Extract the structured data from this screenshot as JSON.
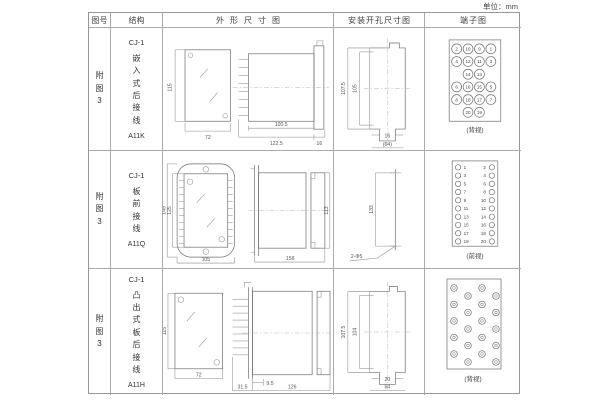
{
  "unit_label": "单位：mm",
  "table": {
    "headers": [
      "图号",
      "结构",
      "外形尺寸图",
      "安装开孔尺寸图",
      "端子图"
    ],
    "rows": [
      {
        "figure_no": "附图3",
        "structure": {
          "model": "CJ-1",
          "desc": "嵌入式后接线",
          "code": "A11K"
        },
        "outline_dims": {
          "h": "115",
          "w": "72",
          "body": "100.5",
          "total": "122.5",
          "flange": "16"
        },
        "mounting_dims": {
          "outer": "107.5",
          "inner": "105",
          "slot": "16",
          "overall": "(64)"
        },
        "terminal": {
          "view": "(背视)",
          "layout": "grid",
          "numbers": [
            [
              2,
              10,
              9,
              1
            ],
            [
              4,
              12,
              11,
              3
            ],
            [
              null,
              14,
              13,
              null
            ],
            [
              6,
              16,
              15,
              5
            ],
            [
              8,
              18,
              17,
              7
            ],
            [
              null,
              20,
              19,
              null
            ]
          ]
        }
      },
      {
        "figure_no": "附图3",
        "structure": {
          "model": "CJ-1",
          "desc": "板前接线",
          "code": "A11Q"
        },
        "outline_dims": {
          "outer_h": "149",
          "inner_h": "125",
          "w": "105",
          "len": "156",
          "side_h": "113"
        },
        "mounting_dims": {
          "spacing": "133",
          "holes": "2-Φ5"
        },
        "terminal": {
          "view": "(前视)",
          "layout": "two-col",
          "left": [
            1,
            3,
            5,
            7,
            9,
            11,
            13,
            15,
            17,
            19
          ],
          "right": [
            2,
            4,
            6,
            8,
            10,
            12,
            14,
            16,
            18,
            20
          ]
        }
      },
      {
        "figure_no": "附图3",
        "structure": {
          "model": "CJ-1",
          "desc": "凸出式板后接线",
          "code": "A11H"
        },
        "outline_dims": {
          "h": "115",
          "w": "72",
          "stud": "9.5",
          "offset": "31.5",
          "len": "126"
        },
        "mounting_dims": {
          "outer": "107.5",
          "inner": "104",
          "slot": "20",
          "overall": "64"
        },
        "terminal": {
          "view": "(背视)",
          "layout": "stud-grid"
        }
      }
    ]
  }
}
